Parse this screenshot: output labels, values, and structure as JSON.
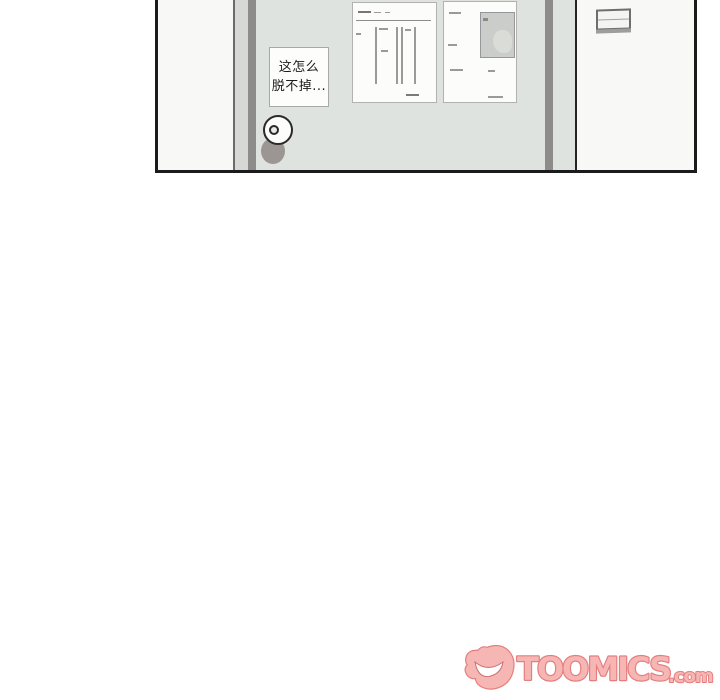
{
  "comic_panel": {
    "speech_note": {
      "line1": "这怎么",
      "line2": "脱不掉..."
    },
    "colors": {
      "wall": "#f8f8f6",
      "door": "#dfe3e0",
      "frame_light": "#d6d8d5",
      "frame_dark": "#8e8c8a",
      "panel_border": "#1b1b1b",
      "knob_shadow": "#9b9693",
      "poster_paper": "#fcfcfa",
      "photo_gray": "#cbcdca"
    }
  },
  "watermark": {
    "brand": "TOOMICS",
    "suffix": ".com",
    "fill": "#f6b6b4",
    "outline": "#e57f7f"
  }
}
